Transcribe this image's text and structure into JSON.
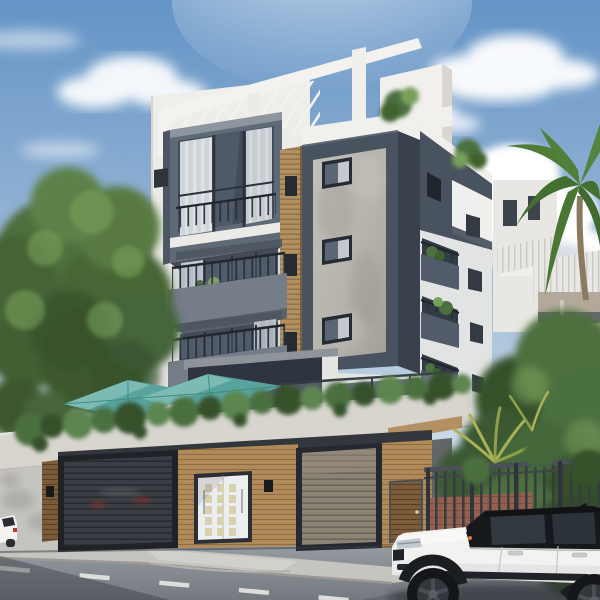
{
  "meta": {
    "description": "Photorealistic daytime architectural rendering of a modern four-storey white apartment building with a central concrete tower, chamfered grey balconies, rooftop pergola, teal patio umbrellas over a planted terrace wall, wooden garage level with two louvered garage doors and a white entry door, leafy trees at left, tropical palms and a metal fence at right, and a white SUV with a black roof parked on the street in front.",
    "setting": "clear blue sky with scattered cumulus clouds, low camera angle from the street corner"
  },
  "scene": {
    "objects": [
      "sky",
      "sun-glow",
      "clouds",
      "left-trees",
      "palm-tree",
      "background-building-white",
      "background-building-beige",
      "ridged-roof",
      "main-building",
      "rooftop-pergola",
      "stair-bulkhead",
      "roof-shrubs",
      "bay-window",
      "louver-screen",
      "concrete-tower",
      "tower-windows",
      "balconies-left",
      "right-wing-balconies",
      "terrace-glass-railing",
      "patio-umbrella-left",
      "patio-umbrella-right",
      "planter-ledge",
      "trailing-plants",
      "perimeter-wall",
      "garage-door-left",
      "garage-door-right",
      "entry-door",
      "pedestrian-gate",
      "wall-sconces",
      "metal-fence",
      "brick-wall",
      "tropical-foliage",
      "street",
      "sidewalk",
      "driveway-apron",
      "lane-marking",
      "parked-car-partial",
      "white-suv"
    ],
    "counts": {
      "umbrellas": 2,
      "garage_doors": 2,
      "tower_windows": 3,
      "left_balconies": 2,
      "right_wing_balconies": 3,
      "cars": 2
    }
  },
  "palette": {
    "sky_top": "#6494c6",
    "sky_mid": "#9db9d7",
    "sky_horizon": "#d3dfe9",
    "cloud_white": "#ffffff",
    "facade_white": "#f0efeb",
    "facade_shade": "#e0dfda",
    "slate_dark": "#49525f",
    "slate_deep": "#39414c",
    "balcony_gray": "#747d88",
    "concrete_gray": "#b6b3ac",
    "wood_tan": "#b08a58",
    "wood_shadow": "#7c5c38",
    "louver_tan": "#b2905f",
    "umbrella_teal": "#58a39d",
    "umbrella_light": "#82c0b9",
    "plant_green": "#4c7040",
    "plant_dark": "#36512c",
    "tree_green": "#4e6f3c",
    "tree_light": "#77a05a",
    "palm_green": "#4f7c36",
    "palm_yellow": "#a9b055",
    "glass_dark": "#424c5a",
    "curtain_white": "#e9ebee",
    "garage_anthracite": "#3a3e44",
    "garage_bronze": "#8b8376",
    "door_white": "#eceef0",
    "door_glass": "#d8d1ae",
    "fence_dark": "#363b41",
    "brick_red": "#96604e",
    "wall_concrete": "#c6c4c0",
    "street_gray": "#9aa0a6",
    "street_dark": "#5f6368",
    "sidewalk": "#c6c4bf",
    "marking_white": "#e8e8e5",
    "car_white": "#f2f2f1",
    "car_black": "#16181b",
    "wheel_gray": "#33373c",
    "signal_orange": "#d97a2e",
    "bg_beige": "#b2a99a",
    "bg_white": "#e8e7e3"
  }
}
